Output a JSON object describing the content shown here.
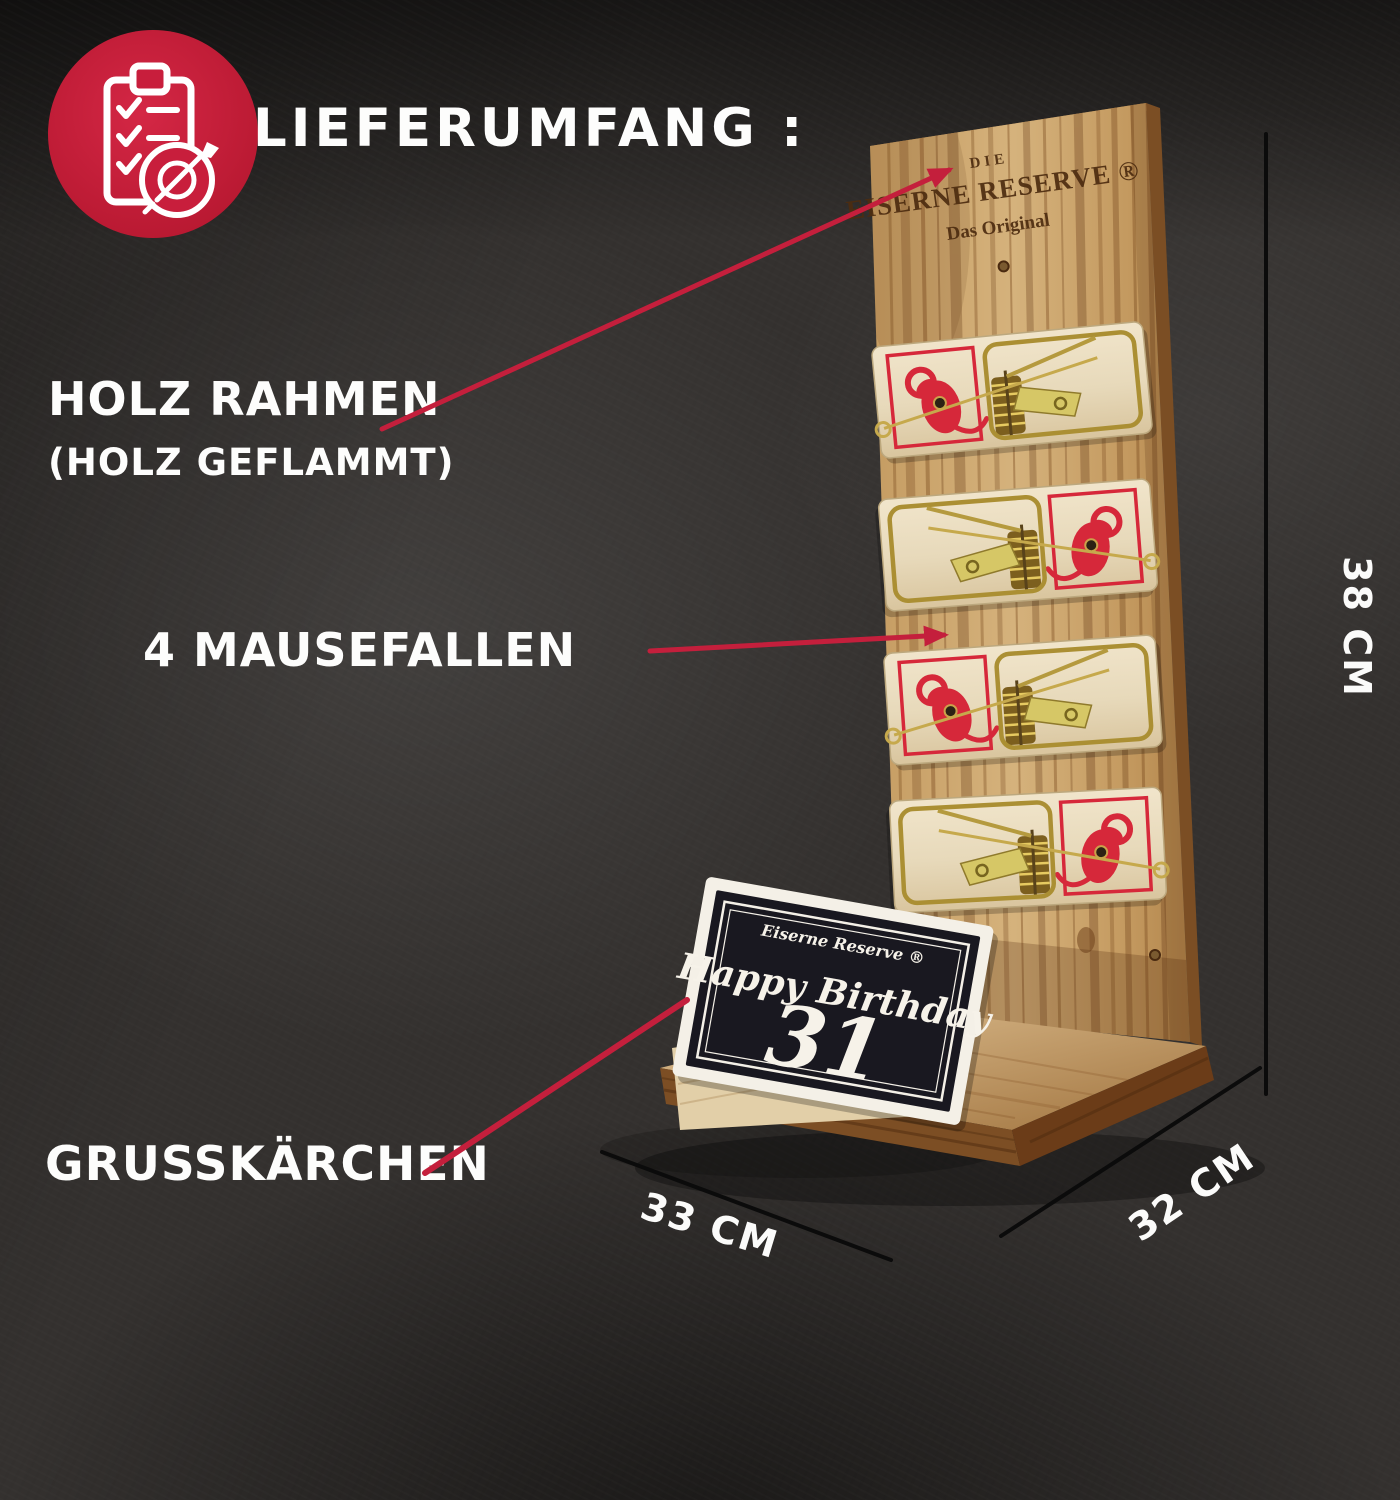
{
  "title": "LIEFERUMFANG :",
  "badge": {
    "icon": "clipboard-checklist-target-icon",
    "color": "#c81e3c"
  },
  "callouts": {
    "frame": {
      "label": "HOLZ RAHMEN",
      "sublabel": "(HOLZ GEFLAMMT)"
    },
    "traps": {
      "label": "4 MAUSEFALLEN"
    },
    "card": {
      "label": "GRUSSKÄRCHEN"
    }
  },
  "dimensions": {
    "height_label": "38 CM",
    "width_label": "33 CM",
    "depth_label": "32 CM"
  },
  "product": {
    "board_brand": {
      "line1": "DIE",
      "line2": "EISERNE RESERVE ®",
      "line3": "Das Original"
    },
    "greeting_card": {
      "brand": "Eiserne Reserve ®",
      "line1": "Happy Birthday",
      "number": "31"
    },
    "trap_count": 4
  },
  "colors": {
    "accent_red": "#c41f3c",
    "badge_red": "#c81e3c",
    "label_text": "#fdfdfc",
    "dimension_line": "#0b0b0b",
    "card_black": "#191820",
    "mouse_print_red": "#d6283a",
    "wood_mid": "#c49b63",
    "trap_wood": "#e9dcc0",
    "brass": "#ab8f33"
  }
}
